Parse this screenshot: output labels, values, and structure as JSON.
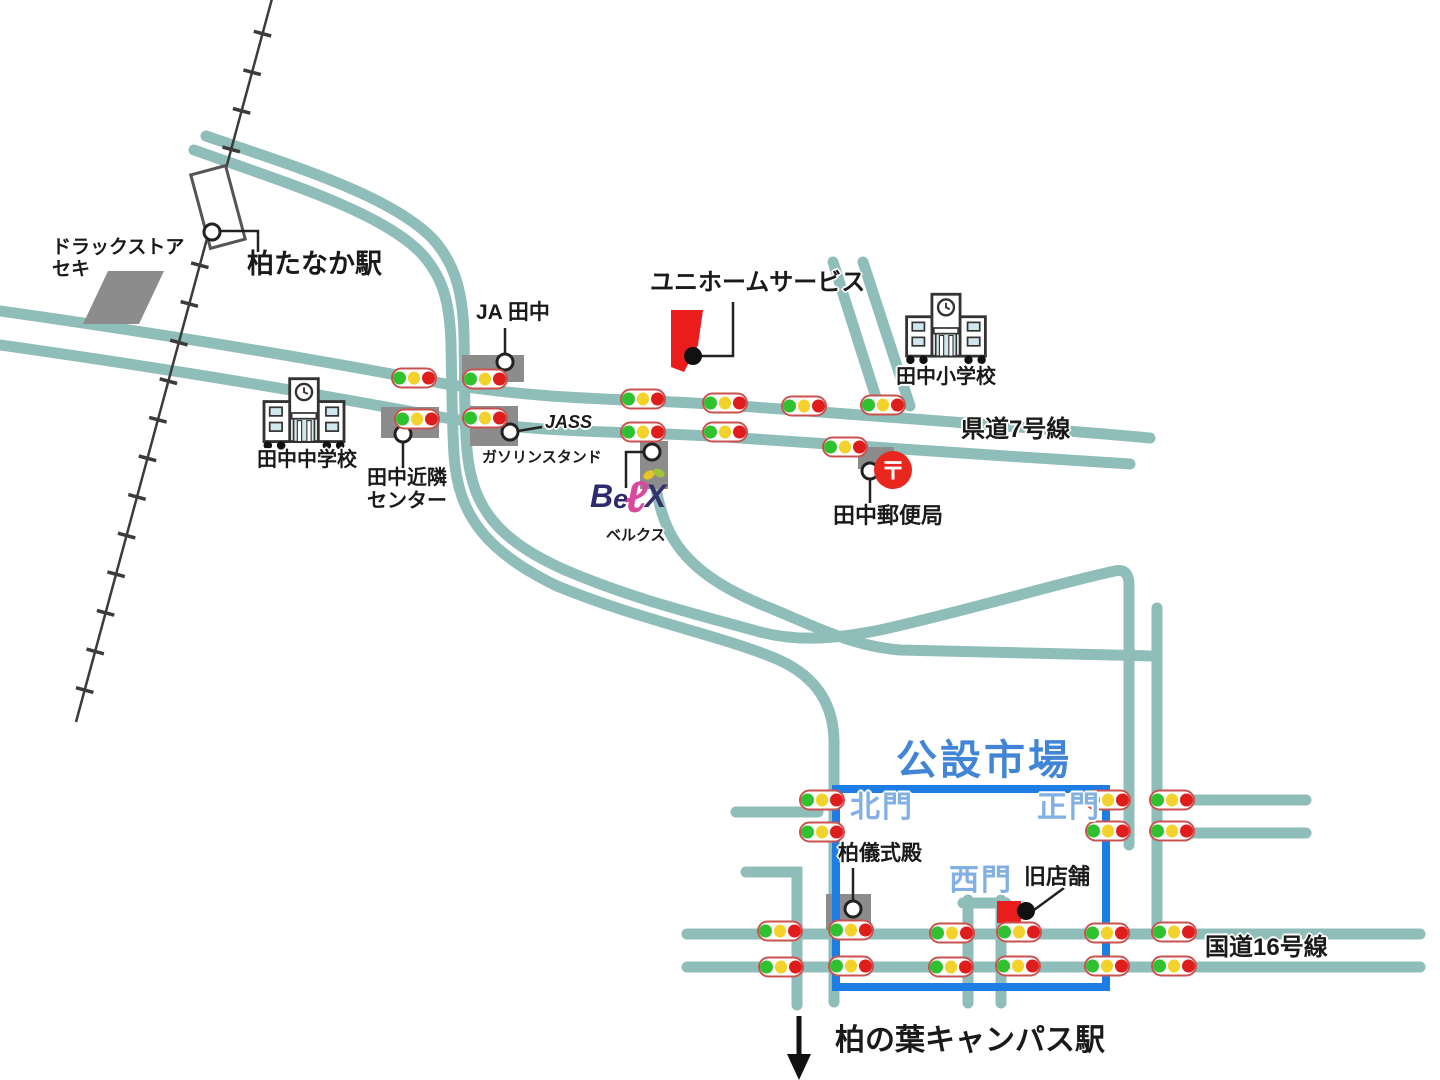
{
  "map": {
    "labels": {
      "drugstore_1": "ドラックストア",
      "drugstore_2": "セキ",
      "station": "柏たなか駅",
      "ja_tanaka": "JA 田中",
      "uniform_service": "ユニホームサービス",
      "elementary_school": "田中小学校",
      "prefectural_road": "県道7号線",
      "junior_high_school": "田中中学校",
      "neighborhood_center_1": "田中近隣",
      "neighborhood_center_2": "センター",
      "jass": "JASS",
      "gas_station": "ガソリンスタンド",
      "belx_kana": "ベルクス",
      "post_office": "田中郵便局",
      "public_market": "公設市場",
      "north_gate": "北門",
      "main_gate": "正門",
      "west_gate": "西門",
      "ceremony_hall": "柏儀式殿",
      "old_shop": "旧店舗",
      "national_route": "国道16号線",
      "campus_station": "柏の葉キャンパス駅",
      "post_mark": "〒",
      "belx_b": "B",
      "belx_e": "e",
      "belx_l": "ℓ",
      "belx_x": "X"
    },
    "colors": {
      "road": "#8fbdb9",
      "railway": "#3b3b3b",
      "market_outline": "#1d7de4",
      "market_text": "#4285d6",
      "gate_text": "#82b0e4",
      "building_gray": "#8c8c8c",
      "landmark_red": "#ea1c1c",
      "signal_green": "#2fc12f",
      "signal_yellow": "#f3d32b",
      "signal_red": "#e01d1d"
    },
    "traffic_lights": [
      [
        414,
        378
      ],
      [
        485,
        379
      ],
      [
        417,
        419
      ],
      [
        485,
        418
      ],
      [
        643,
        399
      ],
      [
        643,
        432
      ],
      [
        725,
        403
      ],
      [
        725,
        432
      ],
      [
        804,
        406
      ],
      [
        883,
        405
      ],
      [
        845,
        447
      ],
      [
        822,
        800
      ],
      [
        822,
        832
      ],
      [
        1108,
        800
      ],
      [
        1108,
        831
      ],
      [
        1172,
        800
      ],
      [
        1172,
        831
      ],
      [
        780,
        931
      ],
      [
        851,
        930
      ],
      [
        952,
        933
      ],
      [
        1019,
        932
      ],
      [
        1107,
        933
      ],
      [
        1174,
        932
      ],
      [
        781,
        967
      ],
      [
        851,
        966
      ],
      [
        951,
        967
      ],
      [
        1018,
        966
      ],
      [
        1107,
        966
      ],
      [
        1174,
        966
      ]
    ]
  }
}
